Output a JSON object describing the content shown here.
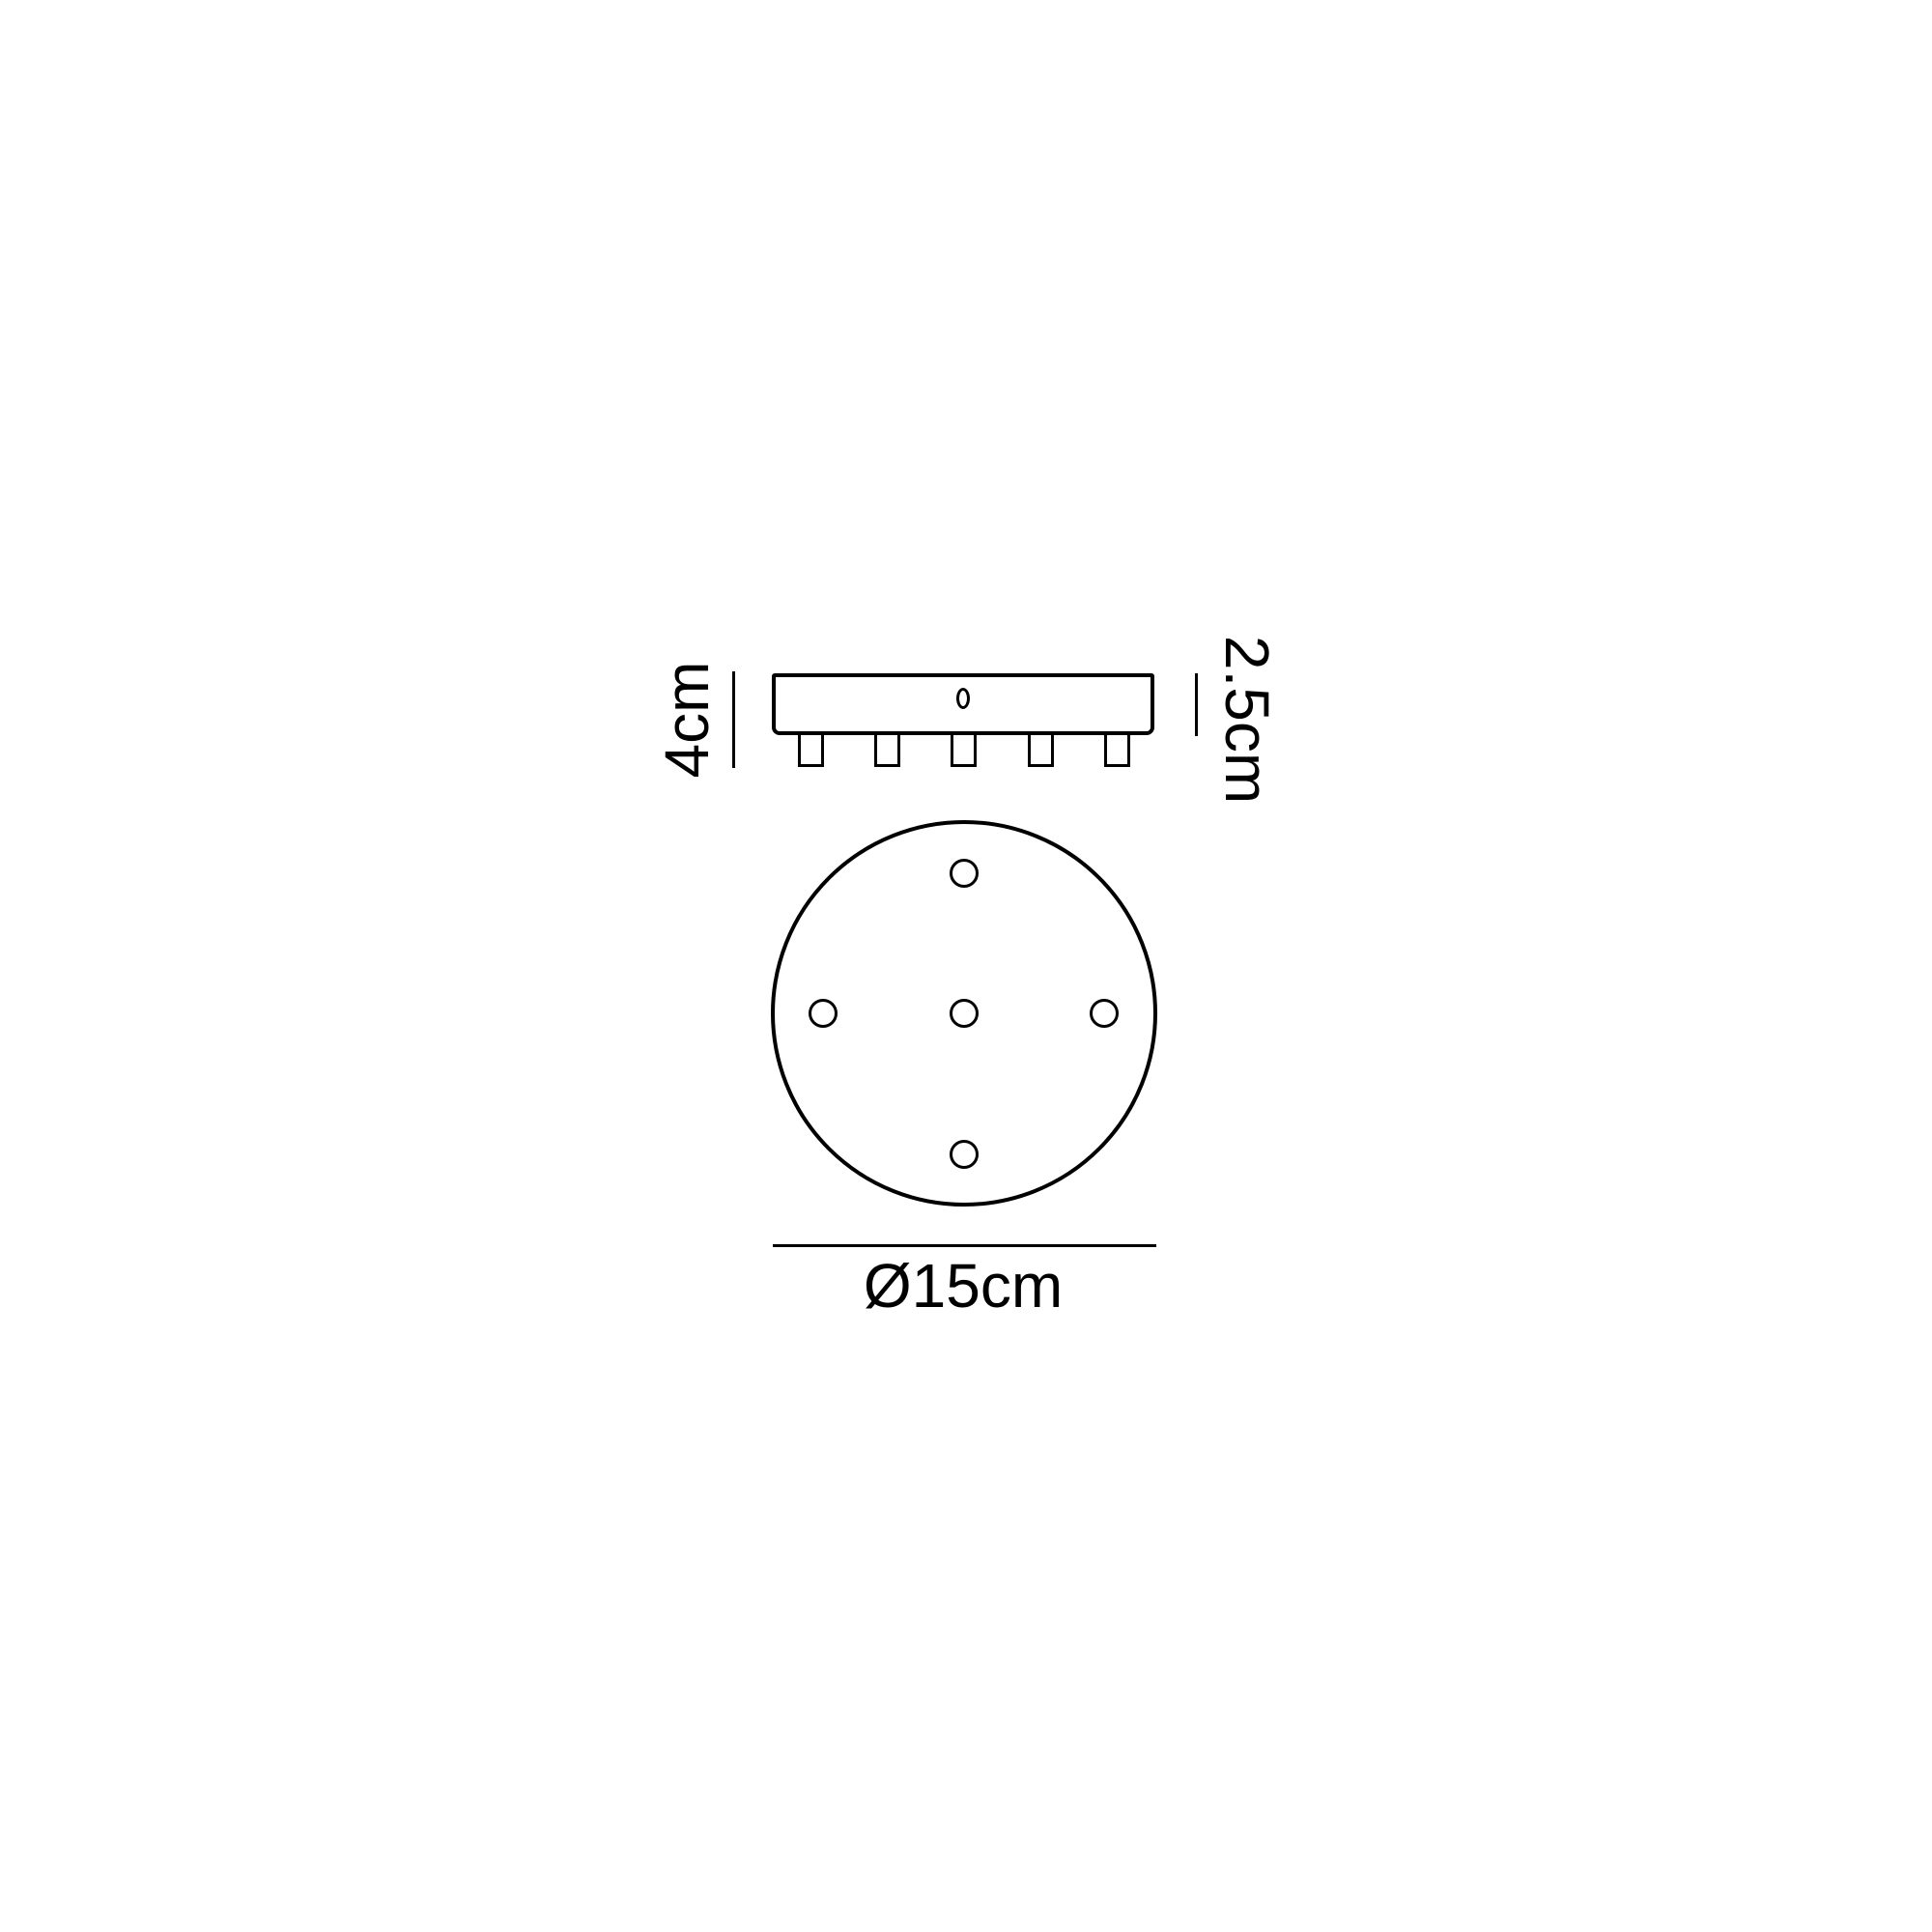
{
  "canvas": {
    "background": "#ffffff",
    "stroke_color": "#000000"
  },
  "side_view": {
    "total_height_label": "4cm",
    "plate_thickness_label": "2.5cm",
    "connector_count": 5,
    "keyhole_count": 1
  },
  "top_view": {
    "diameter_label": "Ø15cm",
    "hole_count": 5
  }
}
